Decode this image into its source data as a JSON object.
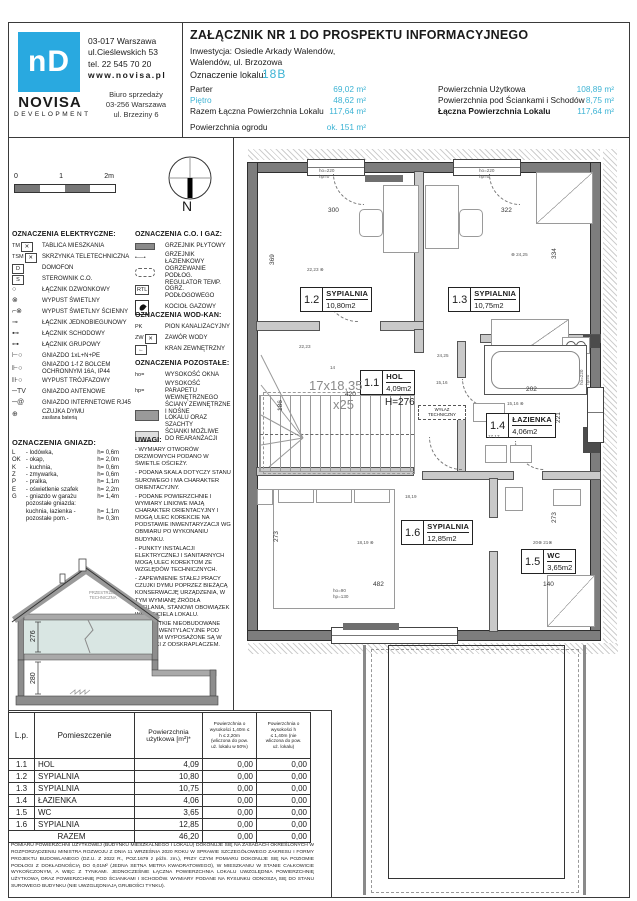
{
  "header": {
    "logo_glyph": "nD",
    "brand": "NOVISA",
    "brand_sub": "DEVELOPMENT",
    "address": [
      "03-017 Warszawa",
      "ul.Cieślewskich 53",
      "tel.  22 545 70 20"
    ],
    "www": "www.novisa.pl",
    "office": [
      "Biuro sprzedaży",
      "03-256 Warszawa",
      "ul. Brzeziny 6"
    ],
    "title": "ZAŁĄCZNIK NR 1 DO PROSPEKTU INFORMACYJNEGO",
    "investment1": "Inwestycja: Osiedle Arkady Walendów,",
    "investment2": "Walendów, ul. Brzozowa",
    "unit_label": "Oznaczenie lokalu:",
    "unit_value": "18B",
    "stats_left": [
      {
        "label": "Parter",
        "value": "69,02 m²"
      },
      {
        "label": "Piętro",
        "value": "48,62 m²",
        "cls": "blue"
      },
      {
        "label": "Razem Łączna Powierzchnia Lokalu",
        "value": "117,64 m²"
      },
      {
        "label": "Powierzchnia ogrodu",
        "value": "ok. 151 m²",
        "gap": true
      }
    ],
    "stats_right": [
      {
        "label": "Powierzchnia Użytkowa",
        "value": "108,89 m²"
      },
      {
        "label": "Powierzchnia pod Ściankami i Schodów",
        "value": "8,75 m²"
      },
      {
        "label": "Łączna Powierzchnia Lokalu",
        "value": "117,64 m²",
        "bold": true
      }
    ]
  },
  "legend": {
    "scale": {
      "t0": "0",
      "t1": "1",
      "t2": "2m"
    },
    "compass_n": "N",
    "electrical": {
      "title": "OZNACZENIA ELEKTRYCZNE:",
      "items": [
        {
          "pre": "TM",
          "sym": "boxx",
          "label": "TABLICA MIESZKANIA"
        },
        {
          "pre": "TSM",
          "sym": "boxx",
          "label": "SKRZYNKA TELETECHNICZNA"
        },
        {
          "sym": "box:D",
          "label": "DOMOFON"
        },
        {
          "sym": "box:S",
          "label": "STEROWNIK C.O."
        },
        {
          "sym": "g:○",
          "label": "ŁĄCZNIK DZWONKOWY"
        },
        {
          "sym": "g:⊗",
          "label": "WYPUST ŚWIETLNY"
        },
        {
          "sym": "g:⌐⊗",
          "label": "WYPUST ŚWIETLNY ŚCIENNY"
        },
        {
          "sym": "g:⊸",
          "label": "ŁĄCZNIK JEDNOBIEGUNOWY"
        },
        {
          "sym": "g:⊷",
          "label": "ŁĄCZNIK SCHODOWY"
        },
        {
          "sym": "g:⊶",
          "label": "ŁĄCZNIK GRUPOWY"
        },
        {
          "sym": "g:⊢○",
          "label": "GNIAZDO 1xL+N+PE"
        },
        {
          "sym": "g:⊩○",
          "label": "GNIAZDO 1-f Z BOLCEM\nOCHRONNYM 16A, IP44"
        },
        {
          "sym": "g:⊪○",
          "label": "WYPUST TRÓJFAZOWY"
        },
        {
          "sym": "g:─TV",
          "label": "GNIAZDO ANTENOWE"
        },
        {
          "sym": "g:─@",
          "label": "GNIAZDO INTERNETOWE RJ45"
        },
        {
          "sym": "g:⊕",
          "label": "CZUJKA DYMU",
          "sub": "zasilana baterią"
        }
      ]
    },
    "co_gaz": {
      "title": "OZNACZENIA C.O. I GAZ:",
      "items": [
        {
          "sym": "bardark",
          "label": "GRZEJNIK PŁYTOWY"
        },
        {
          "sym": "raddots",
          "label": "GRZEJNIK ŁAZIENKOWY"
        },
        {
          "sym": "dashpill",
          "label": "OGRZEWANIE PODŁOG."
        },
        {
          "sym": "box:RTL",
          "label": "REGULATOR TEMP. OGRZ.\nPODŁOGOWEGO"
        },
        {
          "sym": "flame",
          "label": "KOCIOŁ GAZOWY"
        }
      ]
    },
    "wod_kan": {
      "title": "OZNACZENIA WOD-KAN:",
      "items": [
        {
          "pre": "PK",
          "sym": "none",
          "label": "PION KANALIZACYJNY"
        },
        {
          "pre": "ZW",
          "sym": "boxx",
          "label": "ZAWÓR WODY"
        },
        {
          "sym": "box:←",
          "label": "KRAN ZEWNĘTRZNY"
        }
      ]
    },
    "pozostale": {
      "title": "OZNACZENIA POZOSTAŁE:",
      "items": [
        {
          "pre": "ho=",
          "sym": "none",
          "label": "WYSOKOŚĆ OKNA"
        },
        {
          "pre": "hp=",
          "sym": "none",
          "label": "WYSOKOŚĆ PARAPETU\nWEWNĘTRZNEGO"
        },
        {
          "sym": "bardark2",
          "label": "ŚCIANY ZEWNĘTRZNE I NOŚNE\nLOKALU ORAZ SZACHTY"
        },
        {
          "sym": "barlight",
          "label": "ŚCIANKI MOŻLIWE\nDO REARANŻACJI"
        }
      ]
    },
    "gniazda": {
      "title": "OZNACZENIA GNIAZD:",
      "rows": [
        {
          "k": "L",
          "d": "- lodówka,",
          "h": "h= 0,6m"
        },
        {
          "k": "OK",
          "d": "- okap,",
          "h": "h= 2,0m"
        },
        {
          "k": "K",
          "d": "- kuchnia,",
          "h": "h= 0,6m"
        },
        {
          "k": "Z",
          "d": "- zmywarka,",
          "h": "h= 0,6m"
        },
        {
          "k": "P",
          "d": "- pralka,",
          "h": "h= 1,1m"
        },
        {
          "k": "E",
          "d": "- oświetlenie szafek",
          "h": "h= 2,2m"
        },
        {
          "k": "G",
          "d": "- gniazdo w garażu",
          "h": "h= 1,4m"
        },
        {
          "k": "",
          "d": "pozostałe gniazda:",
          "h": ""
        },
        {
          "k": "",
          "d": "kuchnia, łazienka -",
          "h": "h= 1,1m"
        },
        {
          "k": "",
          "d": "pozostałe pom.-",
          "h": "h= 0,3m"
        }
      ]
    },
    "uwagi": {
      "title": "UWAGI:",
      "items": [
        "WYMIARY OTWORÓW DRZWIOWYCH PODANO W ŚWIETLE OŚCIEŻY.",
        "PODANA SKALA DOTYCZY STANU SUROWEGO I MA CHARAKTER ORIENTACYJNY.",
        "PODANE POWIERZCHNIE I WYMIARY LINIOWE MAJĄ CHARAKTER ORIENTACYJNY I MOGĄ ULEC KOREKCIE NA PODSTAWIE INWENTARYZACJI WG OBMIARU PO WYKONANIU BUDYNKU.",
        "PUNKTY INSTALACJI ELEKTRYCZNEJ I SANITARNYCH MOGĄ ULEC KOREKTOM ZE  WZGLĘDÓW TECHNICZNYCH.",
        "ZAPEWNIENIE STAŁEJ PRACY CZUJKI DYMU POPRZEZ BIEŻĄCĄ KONSERWACJĘ URZĄDZENIA, W TYM WYMIANĘ ŹRÓDŁA ZASILANIA, STANOWI OBOWIĄZEK WŁAŚCICIELA LOKALU.",
        "WSZYSTKIE NIEOBUDOWANE KANAŁY WENTYLACYJNE POD STROPEM WYPOSAŻONE SĄ W TRÓJNIKI Z ODSKRAPLACZEM."
      ]
    }
  },
  "section": {
    "dim_upper": "276",
    "dim_lower": "280",
    "attic1": "PRZESTRZEŃ",
    "attic2": "TECHNICZNA"
  },
  "plan": {
    "rooms": [
      {
        "num": "1.2",
        "name": "SYPIALNIA",
        "area": "10,80m2",
        "x": 67,
        "y": 150
      },
      {
        "num": "1.3",
        "name": "SYPIALNIA",
        "area": "10,75m2",
        "x": 215,
        "y": 150
      },
      {
        "num": "1.1",
        "name": "HOL",
        "area": "4,09m2",
        "x": 127,
        "y": 233
      },
      {
        "num": "1.4",
        "name": "ŁAZIENKA",
        "area": "4,06m2",
        "x": 253,
        "y": 276
      },
      {
        "num": "1.6",
        "name": "SYPIALNIA",
        "area": "12,85m2",
        "x": 168,
        "y": 383
      },
      {
        "num": "1.5",
        "name": "WC",
        "area": "3,65m2",
        "x": 288,
        "y": 412
      }
    ],
    "dims": [
      {
        "t": "300",
        "x": 95,
        "y": 70
      },
      {
        "t": "322",
        "x": 268,
        "y": 70
      },
      {
        "t": "369",
        "x": 36,
        "y": 128,
        "rot": true
      },
      {
        "t": "334",
        "x": 318,
        "y": 122,
        "rot": true
      },
      {
        "t": "420",
        "x": 112,
        "y": 254
      },
      {
        "t": "186",
        "x": 44,
        "y": 274,
        "rot": true
      },
      {
        "t": "482",
        "x": 140,
        "y": 444
      },
      {
        "t": "140",
        "x": 310,
        "y": 444
      },
      {
        "t": "273",
        "x": 40,
        "y": 405,
        "rot": true
      },
      {
        "t": "273",
        "x": 318,
        "y": 386,
        "rot": true
      },
      {
        "t": "202",
        "x": 293,
        "y": 249
      },
      {
        "t": "221",
        "x": 322,
        "y": 286,
        "rot": true
      }
    ],
    "big_notes": [
      {
        "t": "H=276",
        "x": 152,
        "y": 260,
        "cls": "hnote"
      },
      {
        "t": "17x18,35",
        "x": 76,
        "y": 241,
        "cls": "stairtxt"
      },
      {
        "t": "x25",
        "x": 100,
        "y": 260,
        "cls": "stairtxt"
      }
    ],
    "tiny_notes": [
      {
        "t": "ho=220\nhp=0",
        "x": 86,
        "y": 31
      },
      {
        "t": "ho=220\nhp=0",
        "x": 246,
        "y": 31
      },
      {
        "t": "ho=90\nhp=130",
        "x": 100,
        "y": 451
      },
      {
        "t": "ho=220\nhp=0",
        "x": 346,
        "y": 248,
        "rot": true
      },
      {
        "t": "22,23 ⊗",
        "x": 74,
        "y": 130
      },
      {
        "t": "⊗ 24,25",
        "x": 278,
        "y": 115
      },
      {
        "t": "22,23",
        "x": 66,
        "y": 207
      },
      {
        "t": "24,25",
        "x": 204,
        "y": 216
      },
      {
        "t": "15,16",
        "x": 203,
        "y": 243
      },
      {
        "t": "15,16 ⊗",
        "x": 274,
        "y": 264
      },
      {
        "t": "18,19",
        "x": 172,
        "y": 357
      },
      {
        "t": "18,19 ⊗",
        "x": 124,
        "y": 403
      },
      {
        "t": "20⊗  21⊗",
        "x": 300,
        "y": 403
      },
      {
        "t": "17      17",
        "x": 255,
        "y": 297
      },
      {
        "t": "14",
        "x": 97,
        "y": 228
      }
    ],
    "shaft_label": "PK",
    "wylaz": "WYŁAZ\nTECHNICZNY"
  },
  "table": {
    "col_headers": {
      "c1": "L.p.",
      "c2": "Pomieszczenie",
      "c3": "Powierzchnia\nużytkowa [m²]*",
      "c4": "Powierzchnia o\nwysokości 1,40m ≤\nh ≤ 2,20m\n(wliczona do pow.\nuż. lokalu w 50%)",
      "c5": "Powierzchnia o\nwysokości        h\n≤ 1,40m (nie\nwliczona do pow.\nuż. lokalu)"
    },
    "rows": [
      [
        "1.1",
        "HOL",
        "4,09",
        "0,00",
        "0,00"
      ],
      [
        "1.2",
        "SYPIALNIA",
        "10,80",
        "0,00",
        "0,00"
      ],
      [
        "1.3",
        "SYPIALNIA",
        "10,75",
        "0,00",
        "0,00"
      ],
      [
        "1.4",
        "ŁAZIENKA",
        "4,06",
        "0,00",
        "0,00"
      ],
      [
        "1.5",
        "WC",
        "3,65",
        "0,00",
        "0,00"
      ],
      [
        "1.6",
        "SYPIALNIA",
        "12,85",
        "0,00",
        "0,00"
      ]
    ],
    "total_label": "RAZEM",
    "total": [
      "46,20",
      "0,00",
      "0,00"
    ]
  },
  "footer": "POMIARU POWIERZCHNI UŻYTKOWEJ (BUDYNKU MIESZKALNEGO I LOKALU) DOKONUJE SIĘ NA ZASADACH OKREŚLONYCH W ROZPORZĄDZENIU MINISTRA ROZWOJU Z DNIA 11 WRZEŚNIA 2020 ROKU W SPRAWIE SZCZEGÓŁOWEGO ZAKRESU I FORMY PROJEKTU BUDOWLANEGO (DZ.U. Z 2022 R., POZ.1679 z późn. zm.), PRZY CZYM POMIARU DOKONUJE SIĘ NA POZIOMIE PODŁOGI Z DOKŁADNOŚCIĄ DO 0,01M² (JEDNA SETNA METRA KWADRATOWEGO), W MIESZKANIU W STANIE CAŁKOWICIE WYKOŃCZONYM, A WIĘC Z TYNKAMI. JEDNOCZEŚNIE ŁĄCZNA POWIERZCHNIA LOKALU UWZGLĘDNIA POWIERZCHNIĘ UŻYTKOWĄ ORAZ POWIERZCHNIĘ POD ŚCIANKAMI I SCHODÓW. WYMIARY PODANE NA RYSUNKU ODNOSZĄ SIĘ DO STANU SUROWEGO BUDYNKU (NIE UWZGLĘDNIAJĄ GRUBOŚCI TYNKU)."
}
